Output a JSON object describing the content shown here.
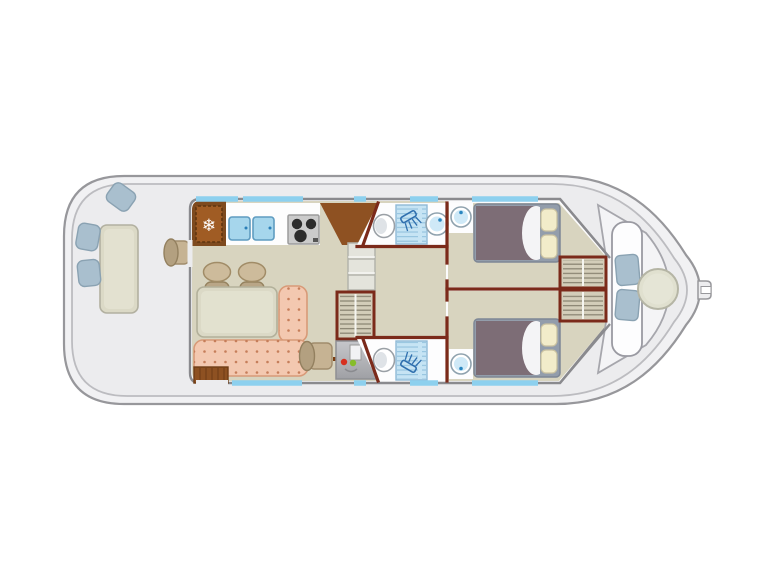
{
  "document": {
    "type": "boat-floor-plan",
    "view": "top-down deck plan of a canal houseboat",
    "orientation": "bow-right, stern-left",
    "background": "#ffffff",
    "visible_text": ""
  },
  "icons": {
    "fridge_snowflake": "❄"
  },
  "palette": {
    "hull_fill": "#f1f1f3",
    "hull_stroke": "#97979b",
    "hull_inner_stroke": "#bcbcc0",
    "deck_fill": "#ececee",
    "cabin_fill": "#fbfbfc",
    "cabin_wall": "#8a8a8e",
    "window_blue": "#8dd0ee",
    "floor_beige": "#d8d4bf",
    "wall_red": "#7b2a1a",
    "wood_brown": "#8e5122",
    "wood_dark": "#7e4a1e",
    "sink_blue": "#a6d6ec",
    "sink_stroke": "#5f9cc0",
    "sofa_pink": "#f3c8b0",
    "sofa_stroke": "#d89a78",
    "sofa_dot": "#c67e5a",
    "cushion_blue": "#a9bfce",
    "cushion_stroke": "#8aa2b2",
    "bed_mauve": "#7d6d76",
    "bed_frame": "#939dab",
    "pillow_cream": "#f2ecca",
    "wardrobe_fill": "#d3cdb9",
    "tile_blue": "#c6e4f4",
    "shower_glyph": "#2f6fae",
    "panel_grey": "#b7b8bc",
    "led_red": "#d63020",
    "led_green": "#86bd2a",
    "stove_grey": "#cbcbcb",
    "burner_black": "#2c2c2c",
    "table_fill": "#dbd9c6"
  },
  "rooms": {
    "aft_deck": {
      "label": "aft-deck",
      "items": [
        {
          "name": "deck-table",
          "count": 1
        },
        {
          "name": "deck-cushion",
          "count": 3
        },
        {
          "name": "exterior-helm-seat",
          "count": 1
        }
      ]
    },
    "galley": {
      "label": "galley",
      "items": [
        {
          "name": "fridge",
          "count": 1,
          "icon": "snowflake"
        },
        {
          "name": "sink-basin",
          "count": 2
        },
        {
          "name": "stove",
          "count": 1,
          "burners": 3
        },
        {
          "name": "corner-counter",
          "count": 1
        }
      ]
    },
    "salon": {
      "label": "salon",
      "items": [
        {
          "name": "dining-table",
          "count": 1
        },
        {
          "name": "stool",
          "count": 2
        },
        {
          "name": "l-shaped-sofa",
          "count": 1
        },
        {
          "name": "interior-helm-chair",
          "count": 1
        },
        {
          "name": "entry-steps",
          "count": 1
        },
        {
          "name": "door-handle",
          "count": 1
        }
      ]
    },
    "midship": {
      "label": "companionway",
      "items": [
        {
          "name": "steps",
          "count": 1,
          "treads": 3
        },
        {
          "name": "wardrobe",
          "count": 1
        },
        {
          "name": "electrical-panel",
          "count": 1,
          "leds": [
            "red",
            "green"
          ]
        }
      ]
    },
    "bathroom_top": {
      "label": "bathroom-port",
      "items": [
        {
          "name": "toilet",
          "count": 1
        },
        {
          "name": "shower",
          "count": 1
        },
        {
          "name": "washbasin",
          "count": 1
        }
      ]
    },
    "bathroom_bottom": {
      "label": "bathroom-starboard",
      "items": [
        {
          "name": "toilet",
          "count": 1
        },
        {
          "name": "shower",
          "count": 1
        }
      ]
    },
    "cabin_top": {
      "label": "cabin-port",
      "items": [
        {
          "name": "double-bed",
          "count": 1,
          "pillows": 2
        },
        {
          "name": "corner-washbasin",
          "count": 1
        },
        {
          "name": "wardrobe",
          "count": 1
        }
      ]
    },
    "cabin_bottom": {
      "label": "cabin-starboard",
      "items": [
        {
          "name": "double-bed",
          "count": 1,
          "pillows": 2
        },
        {
          "name": "corner-washbasin",
          "count": 1
        },
        {
          "name": "wardrobe",
          "count": 1
        }
      ]
    },
    "bow_deck": {
      "label": "bow-deck",
      "items": [
        {
          "name": "curved-bench",
          "count": 1
        },
        {
          "name": "seat-cushion",
          "count": 2
        },
        {
          "name": "round-table",
          "count": 1
        },
        {
          "name": "bow-cleat",
          "count": 1
        }
      ]
    }
  },
  "windows": {
    "color": "#8dd0ee",
    "top_segments": 5,
    "bottom_segments": 4
  }
}
